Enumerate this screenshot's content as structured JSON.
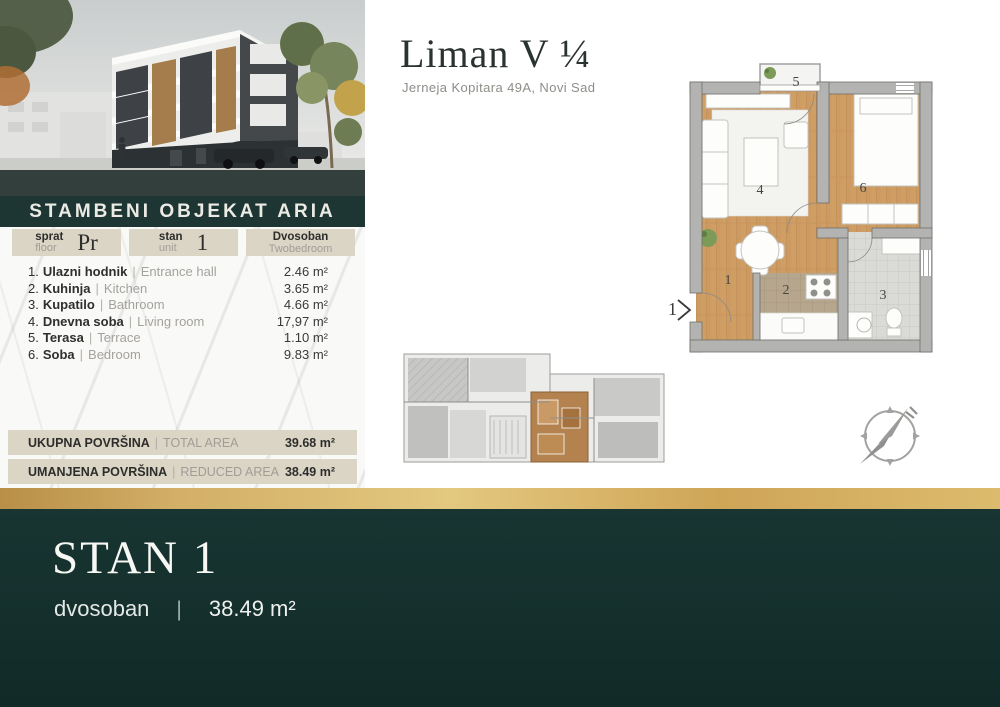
{
  "header": {
    "title": "Liman V ¼",
    "address": "Jerneja Kopitara 49A, Novi Sad"
  },
  "left_panel": {
    "banner": "STAMBENI OBJEKAT ARIA",
    "sep": "|",
    "meta": {
      "floor": {
        "sr": "sprat",
        "en": "floor",
        "value": "Pr"
      },
      "unit": {
        "sr": "stan",
        "en": "unit",
        "value": "1"
      },
      "type": {
        "sr": "Dvosoban",
        "en": "Twobedroom"
      }
    },
    "rooms": [
      {
        "num": "1.",
        "sr": "Ulazni hodnik",
        "en": "Entrance hall",
        "area": "2.46 m²"
      },
      {
        "num": "2.",
        "sr": "Kuhinja",
        "en": "Kitchen",
        "area": "3.65 m²"
      },
      {
        "num": "3.",
        "sr": "Kupatilo",
        "en": "Bathroom",
        "area": "4.66 m²"
      },
      {
        "num": "4.",
        "sr": "Dnevna soba",
        "en": "Living room",
        "area": "17,97 m²"
      },
      {
        "num": "5.",
        "sr": "Terasa",
        "en": "Terrace",
        "area": "1.10 m²"
      },
      {
        "num": "6.",
        "sr": "Soba",
        "en": "Bedroom",
        "area": "9.83 m²"
      }
    ],
    "totals": [
      {
        "sr": "UKUPNA POVRŠINA",
        "en": "TOTAL AREA",
        "value": "39.68 m²"
      },
      {
        "sr": "UMANJENA POVRŠINA",
        "en": "REDUCED AREA",
        "value": "38.49 m²"
      }
    ]
  },
  "plan": {
    "numbers": {
      "n1": "1",
      "n2": "2",
      "n3": "3",
      "n4": "4",
      "n5": "5",
      "n6": "6"
    },
    "entrance": "1"
  },
  "footer": {
    "title": "STAN 1",
    "type": "dvosoban",
    "sep": "|",
    "area": "38.49 m²"
  },
  "colors": {
    "teal_dark": "#14302d",
    "teal_banner": "#1d3633",
    "gold": "#d3af67",
    "beige": "#dbd5c6",
    "wood": "#cf9e63",
    "wall_gray": "#b3b3b1"
  }
}
